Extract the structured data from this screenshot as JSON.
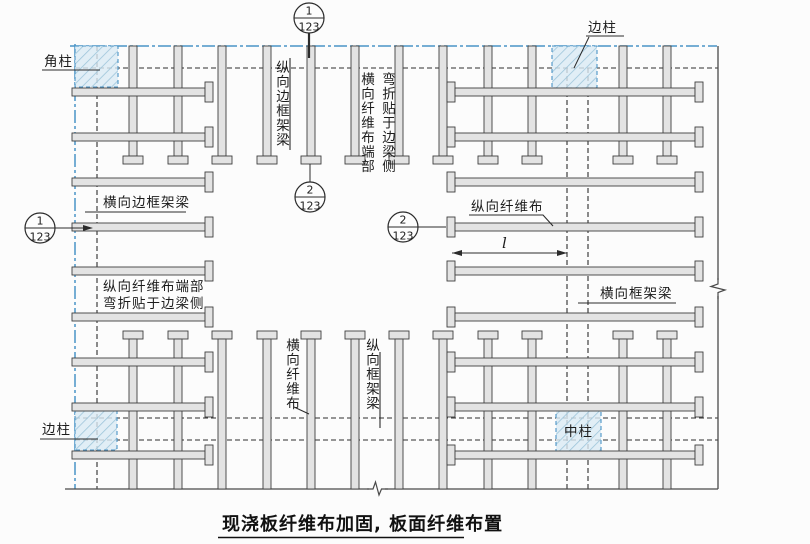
{
  "title": {
    "text": "现浇板纤维布加固, 板面纤维布置"
  },
  "callouts": {
    "c1_top": {
      "num": "1",
      "sheet": "123"
    },
    "c2_top": {
      "num": "2",
      "sheet": "123"
    },
    "c1_left": {
      "num": "1",
      "sheet": "123"
    },
    "c2_mid": {
      "num": "2",
      "sheet": "123"
    }
  },
  "labels": {
    "corner_column": "角柱",
    "edge_column_top": "边柱",
    "edge_column_left": "边柱",
    "center_column": "中柱",
    "longitudinal_edge_frame_beam": "纵向边框架梁",
    "transverse_fiber_end_note_col1": "横向纤维布端部",
    "transverse_fiber_end_note_col2": "弯折贴于边梁侧",
    "transverse_edge_frame_beam": "横向边框架梁",
    "longitudinal_fiber_end_note_line1": "纵向纤维布端部",
    "longitudinal_fiber_end_note_line2": "弯折贴于边梁侧",
    "longitudinal_fiber_cloth": "纵向纤维布",
    "transverse_fiber_cloth": "横向纤维布",
    "longitudinal_frame_beam": "纵向框架梁",
    "transverse_frame_beam": "横向框架梁",
    "length_dimension": "l"
  },
  "colors": {
    "accent": "#4a94c6",
    "column_fill": "#d9eaf4",
    "hatch_line": "#9dc5da",
    "strip_fill": "#e3e3e3",
    "line_dark": "#2e2e2e",
    "background": "#fcfcfc"
  }
}
